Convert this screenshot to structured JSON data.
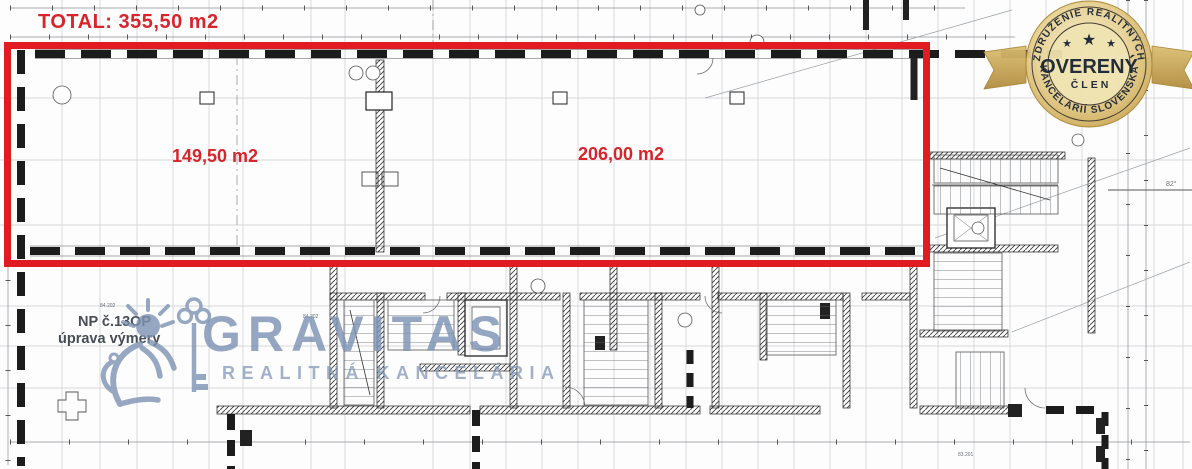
{
  "plan": {
    "total_label": "TOTAL: 355,50 m2",
    "area_left_label": "149,50 m2",
    "area_right_label": "206,00 m2",
    "unit_note_line1": "NP č.13OP",
    "unit_note_line2": "úprava výmery",
    "tiny_labels": [
      "84.202",
      "84.202",
      "83.201",
      "82°"
    ],
    "highlight_color": "#e11b22",
    "label_color": "#d6252b"
  },
  "watermark": {
    "brand": "GRAVITAS",
    "subtitle": "REALITNÁ KANCELÁRIA",
    "color": "#7d93b3"
  },
  "badge": {
    "arc_top": "ZDRUŽENIE REALITNÝCH",
    "arc_bottom": "KANCELÁRIÍ SLOVENSKA",
    "title": "OVERENÝ",
    "subtitle": "ČLEN",
    "star": "★",
    "gold_color": "#d3b263",
    "text_color": "#18222f"
  }
}
